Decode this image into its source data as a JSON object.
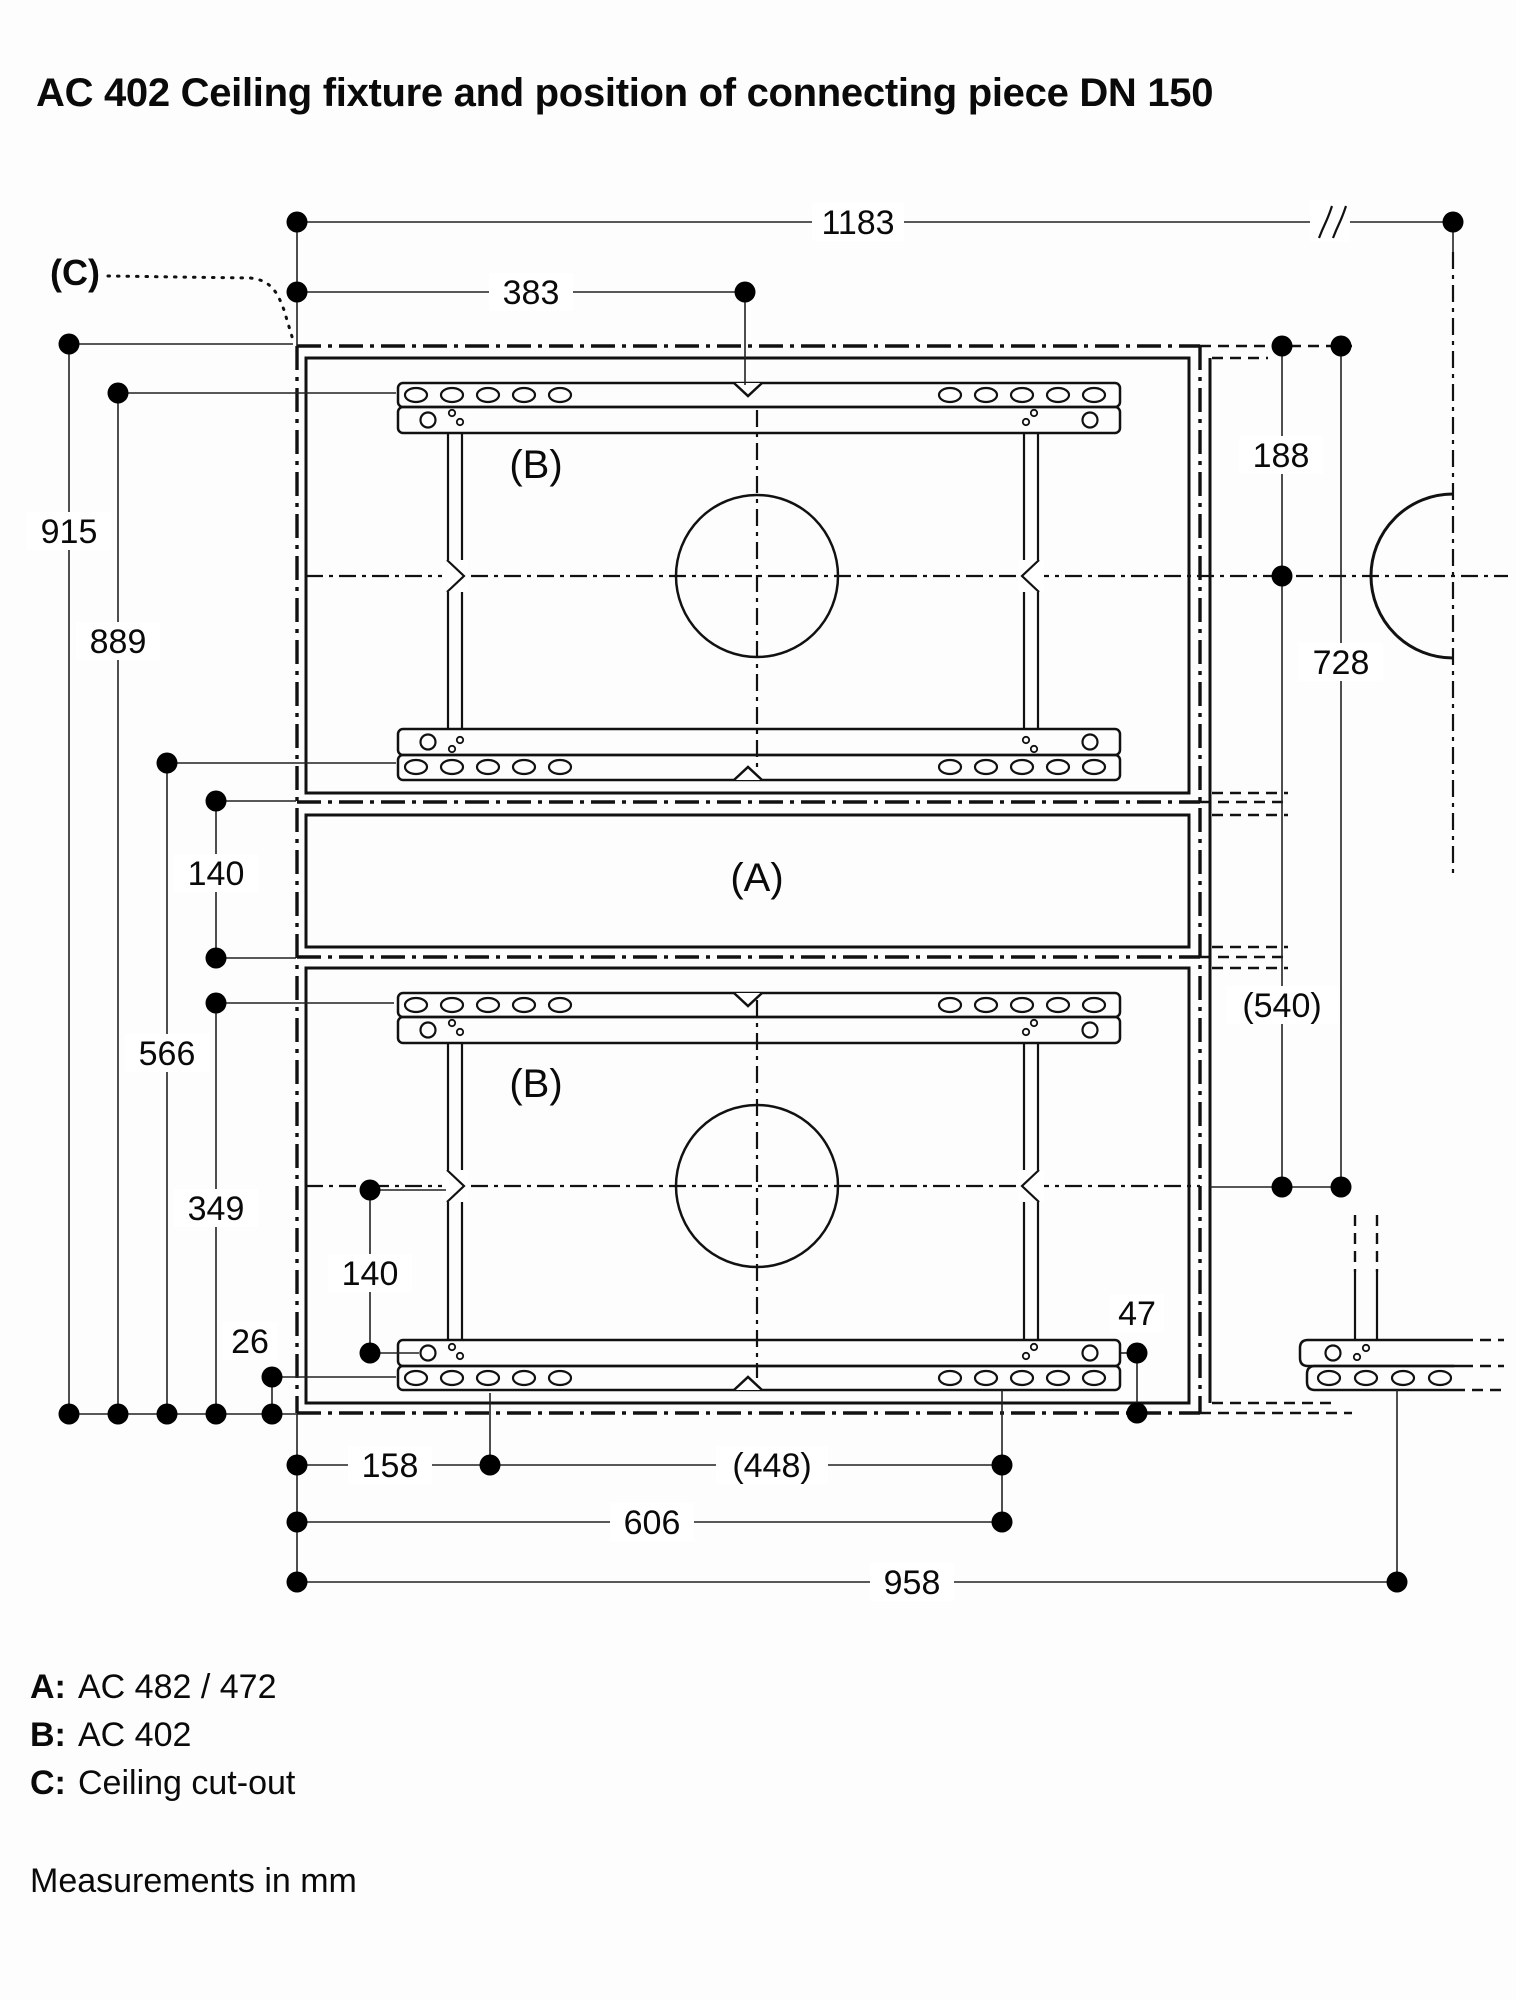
{
  "title": "AC 402 Ceiling fixture and position of connecting piece DN 150",
  "part_labels": {
    "a": "(A)",
    "b_upper": "(B)",
    "b_lower": "(B)",
    "c": "(C)"
  },
  "dims": {
    "top1183": "1183",
    "top383": "383",
    "left915": "915",
    "left889": "889",
    "left566": "566",
    "left140a": "140",
    "left349": "349",
    "left26": "26",
    "low140b": "140",
    "low47": "47",
    "right188": "188",
    "right540": "(540)",
    "right728": "728",
    "bot158": "158",
    "bot448": "(448)",
    "bot606": "606",
    "bot958": "958"
  },
  "legend": {
    "items": [
      {
        "key": "A:",
        "value": "AC 482 / 472"
      },
      {
        "key": "B:",
        "value": "AC 402"
      },
      {
        "key": "C:",
        "value": "Ceiling cut-out"
      }
    ],
    "note": "Measurements in mm"
  }
}
